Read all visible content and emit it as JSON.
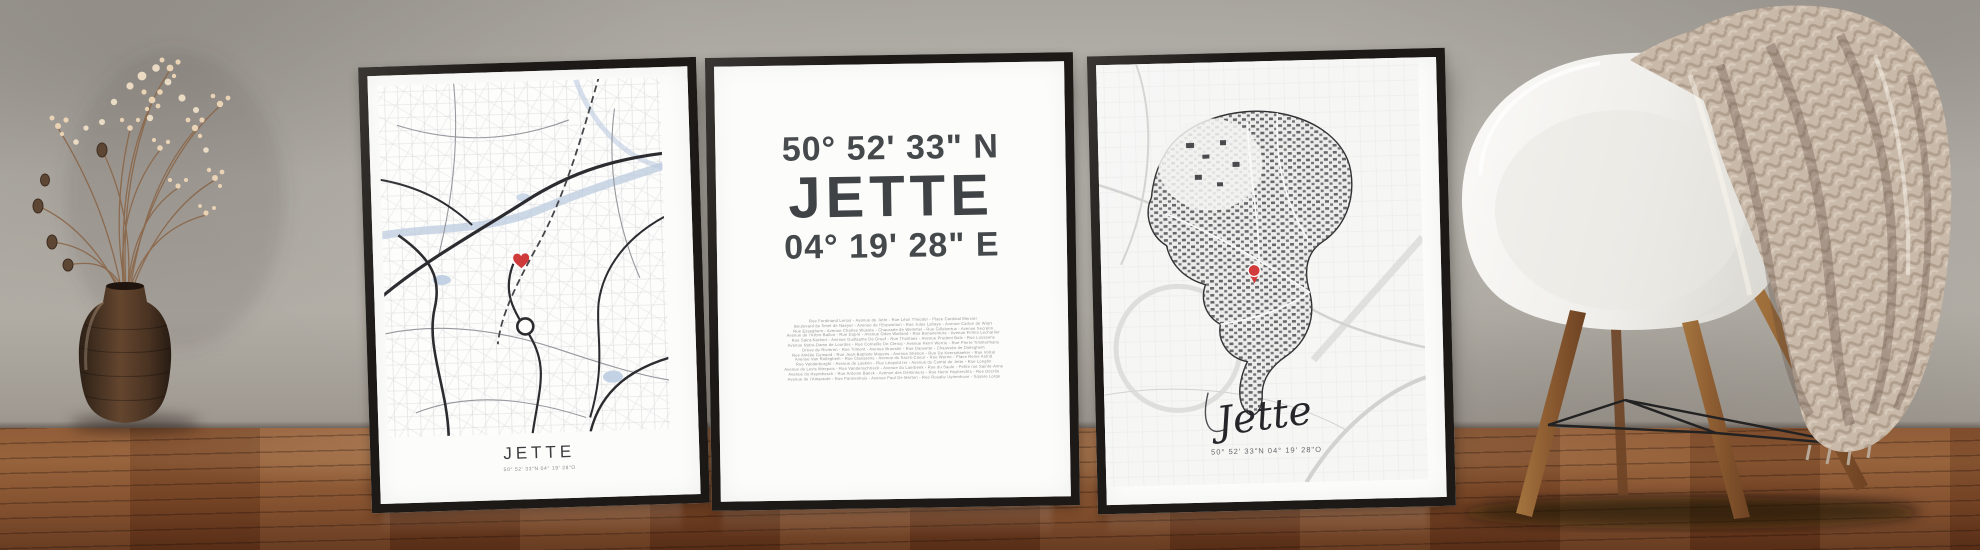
{
  "posters": {
    "left": {
      "title": "JETTE",
      "coordinates": "50° 52' 33\"N 04° 19' 28\"O",
      "marker_icon": "red-heart"
    },
    "middle": {
      "latitude": "50° 52' 33\" N",
      "title": "JETTE",
      "longitude": "04° 19' 28\" E",
      "street_lines": [
        "Rue Ferdinand Lenoir - Avenue de Jette - Rue Léon Theodor - Place Cardinal Mercier",
        "Boulevard de Smet de Naeyer - Avenue de l'Exposition - Rue Jules Lahaye - Avenue Carton de Wiart",
        "Rue Esseghem - Avenue Charles Woeste - Chaussée de Wemmel - Rue Gillebertus - Avenue Secrétin",
        "Avenue de l'Arbre Ballon - Rue Dupré - Avenue Odon Warland - Rue Bonaventure - Avenue Firmin Lecharlier",
        "Rue Saint-Norbert - Avenue Guillaume De Greef - Rue Thomaes - Avenue Prudent Bols - Rue Loossens",
        "Avenue Notre-Dame de Lourdes - Rue Corneille De Clercq - Avenue Henri Werrie - Rue Pierre Timmermans",
        "Drève de Rivieren - Rue Tilmont - Avenue Broustin - Rue Dansette - Chaussée de Dieleghem",
        "Rue Amélie Gomand - Rue Jean-Baptiste Moyens - Avenue Stiénon - Rue De Keersmaeker - Rue Volral",
        "Avenue Van Rolleghem - Rue Claessens - Avenue du Sacré-Coeur - Rue Werrie - Place Reine Astrid",
        "Rue Vanderborght - Avenue de Laeken - Rue Léopold Ier - Avenue du Comté de Jette - Rue Longtin",
        "Avenue de Levis Mirepoix - Rue Vandenschrieck - Avenue du Laerbeek - Rue du Saule - Petite rue Sainte-Anne",
        "Avenue du Heymbosch - Rue Antoine Baeck - Avenue des Démineurs - Rue Henri Huybrechts - Rue Decrée",
        "Avenue de l'Amarante - Rue Pannenhuis - Avenue Paul De Merten - Rue Rosalie Uyttenhove - Square Lorge"
      ]
    },
    "right": {
      "script_title": "Jette",
      "coordinates": "50° 52' 33\"N 04° 19' 28\"O",
      "marker_icon": "red-location-pin"
    }
  },
  "icons": {
    "heart": "red-heart-map-marker",
    "pin": "red-location-pin-marker"
  },
  "colors": {
    "frame": "#1c1916",
    "paper": "#fcfcfa",
    "heading_text": "#3f4346",
    "map_road_dark": "#2c2c30",
    "map_water": "#bccbdf",
    "marker_red": "#cf3a3a",
    "wall": "#b5b1aa",
    "floor": "#7c4827",
    "blanket": "#c9b9a9",
    "chair_shell": "#f3f2ef",
    "chair_wood": "#8a5a30"
  }
}
